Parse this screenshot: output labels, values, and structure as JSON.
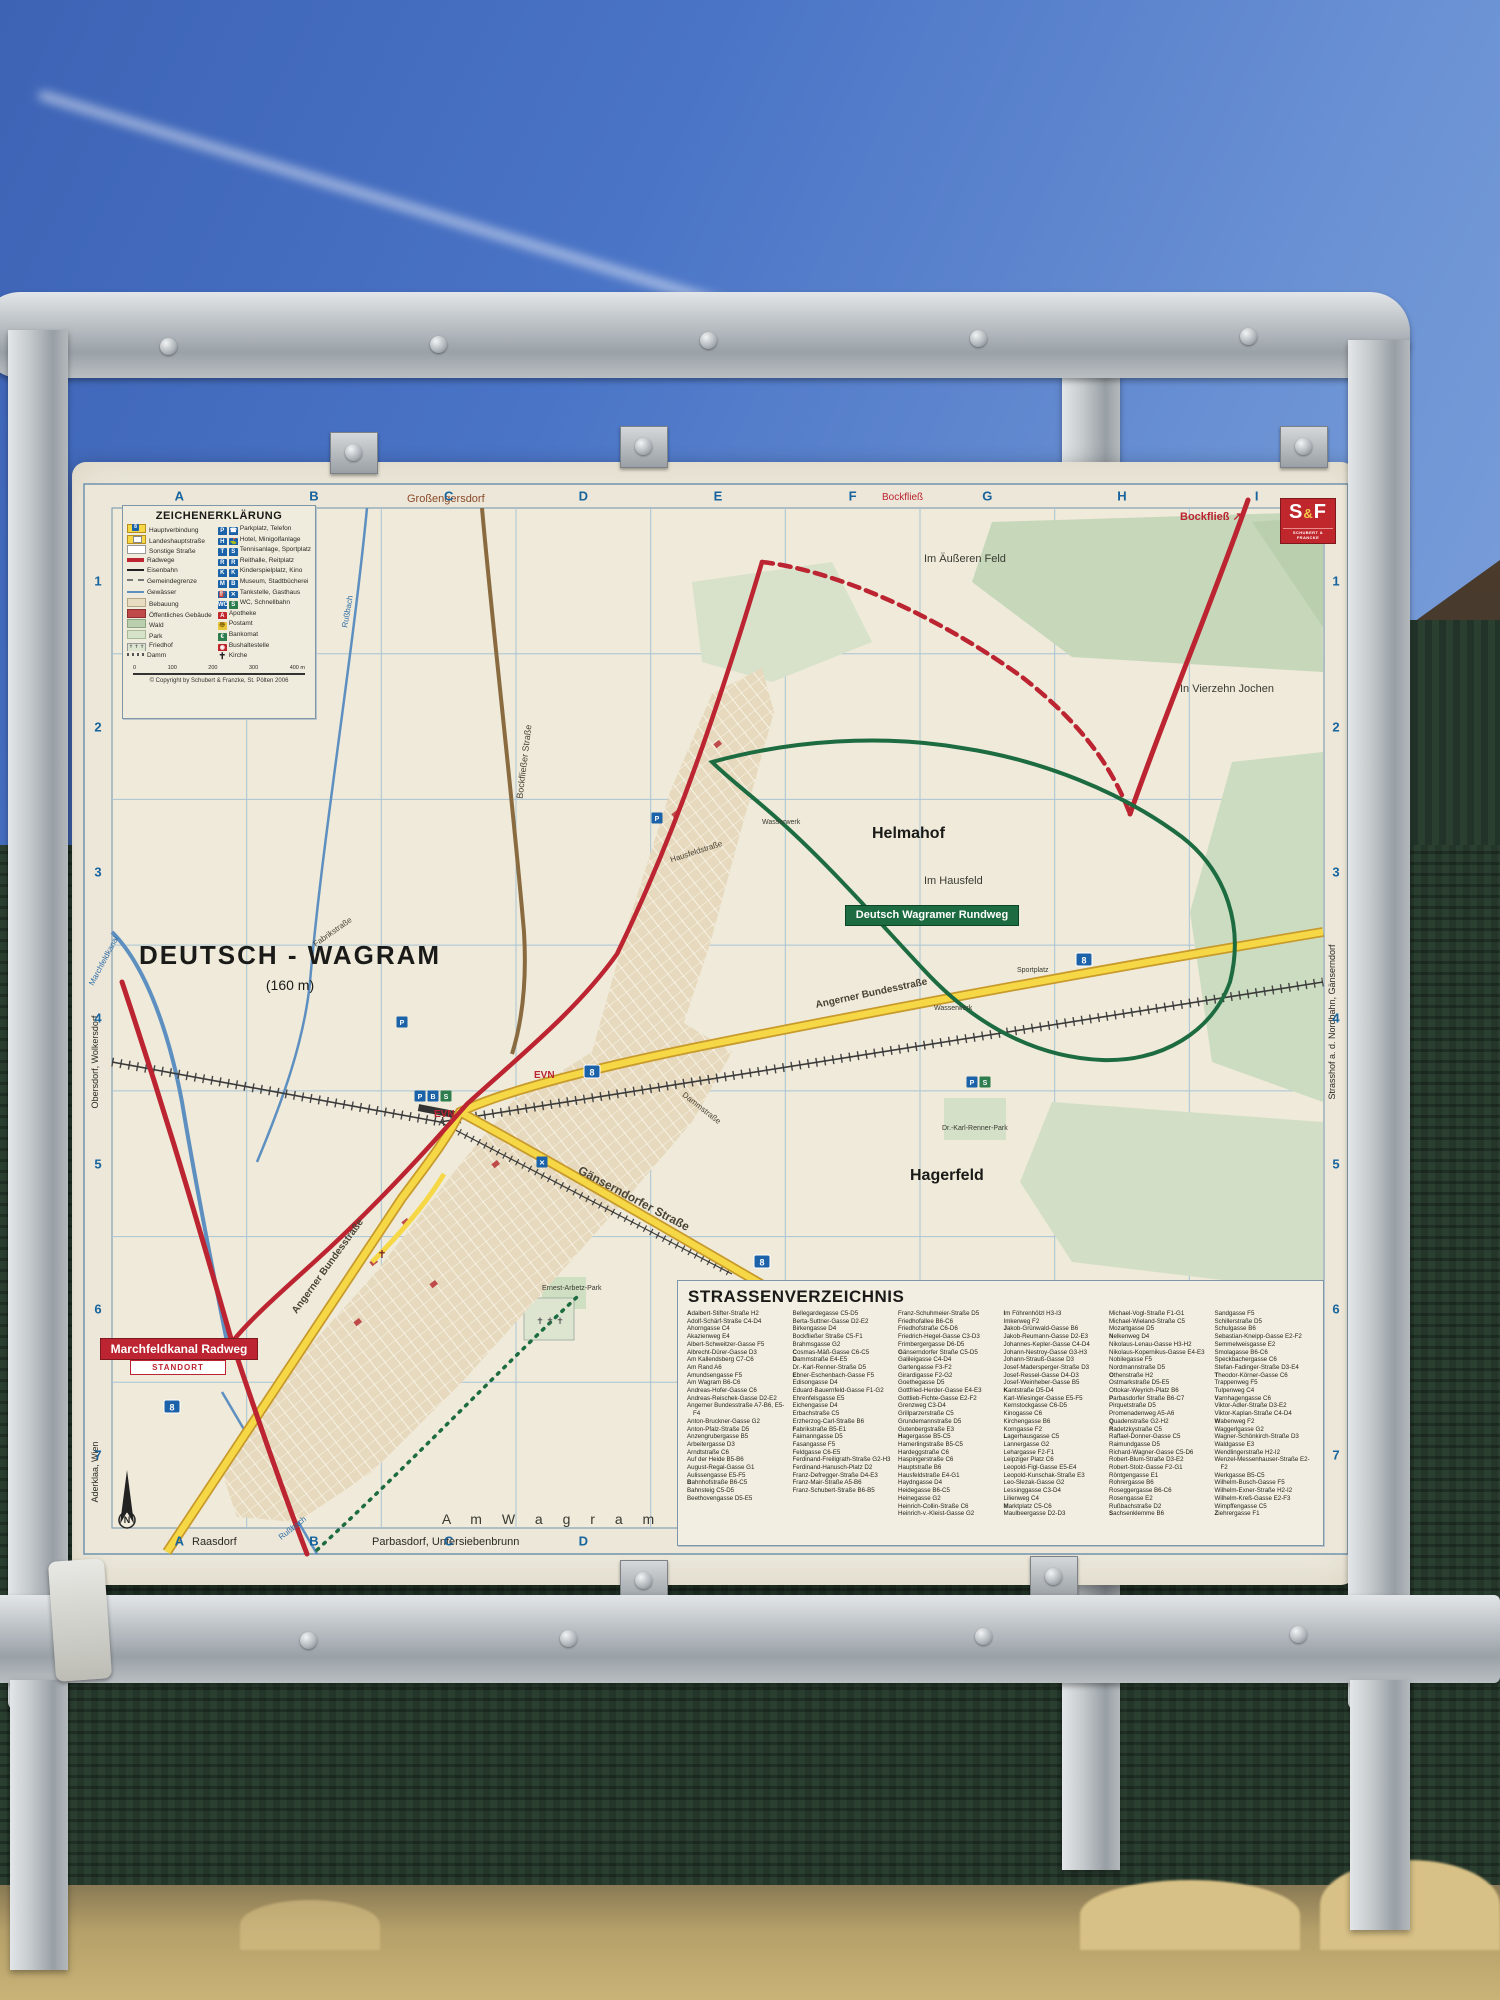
{
  "sign": {
    "title_label": "DEUTSCH - WAGRAM",
    "elevation": "(160 m)",
    "grid": {
      "cols": [
        "A",
        "B",
        "C",
        "D",
        "E",
        "F",
        "G",
        "H",
        "I"
      ],
      "rows": [
        "1",
        "2",
        "3",
        "4",
        "5",
        "6",
        "7"
      ]
    },
    "publisher": {
      "logo_s": "S",
      "logo_amp": "&",
      "logo_f": "F",
      "sub": "SCHUBERT & FRANCKE"
    },
    "legend": {
      "title": "ZEICHENERKLÄRUNG",
      "left": [
        {
          "sym": "main",
          "label": "Hauptverbindung"
        },
        {
          "sym": "lh",
          "label": "Landeshauptstraße"
        },
        {
          "sym": "other",
          "label": "Sonstige Straße"
        },
        {
          "sym": "rad",
          "label": "Radwege"
        },
        {
          "sym": "rail",
          "label": "Eisenbahn"
        },
        {
          "sym": "gem",
          "label": "Gemeindegrenze"
        },
        {
          "sym": "wat",
          "label": "Gewässer"
        },
        {
          "sym": "beb",
          "label": "Bebauung"
        },
        {
          "sym": "pub",
          "label": "Öffentliches Gebäude"
        },
        {
          "sym": "wald",
          "label": "Wald"
        },
        {
          "sym": "park",
          "label": "Park"
        },
        {
          "sym": "fried",
          "label": "Friedhof"
        },
        {
          "sym": "damm",
          "label": "Damm"
        }
      ],
      "right": [
        {
          "icons": [
            {
              "g": "P",
              "c": "blue"
            },
            {
              "g": "☎",
              "c": "blue"
            }
          ],
          "label": "Parkplatz, Telefon"
        },
        {
          "icons": [
            {
              "g": "H",
              "c": "blue"
            },
            {
              "g": "⛳",
              "c": "blue"
            }
          ],
          "label": "Hotel, Minigolfanlage"
        },
        {
          "icons": [
            {
              "g": "T",
              "c": "blue"
            },
            {
              "g": "S",
              "c": "blue"
            }
          ],
          "label": "Tennisanlage, Sportplatz"
        },
        {
          "icons": [
            {
              "g": "R",
              "c": "blue"
            },
            {
              "g": "R",
              "c": "blue"
            }
          ],
          "label": "Reithalle, Reitplatz"
        },
        {
          "icons": [
            {
              "g": "K",
              "c": "blue"
            },
            {
              "g": "K",
              "c": "blue"
            }
          ],
          "label": "Kinderspielplatz, Kino"
        },
        {
          "icons": [
            {
              "g": "M",
              "c": "blue"
            },
            {
              "g": "B",
              "c": "blue"
            }
          ],
          "label": "Museum, Stadtbücherei"
        },
        {
          "icons": [
            {
              "g": "⛽",
              "c": "blue"
            },
            {
              "g": "✕",
              "c": "blue"
            }
          ],
          "label": "Tankstelle, Gasthaus"
        },
        {
          "icons": [
            {
              "g": "WC",
              "c": "blue"
            },
            {
              "g": "S",
              "c": "grn"
            }
          ],
          "label": "WC, Schnellbahn"
        },
        {
          "icons": [
            {
              "g": "A",
              "c": "red"
            }
          ],
          "label": "Apotheke"
        },
        {
          "icons": [
            {
              "g": "〠",
              "c": "yel"
            }
          ],
          "label": "Postamt"
        },
        {
          "icons": [
            {
              "g": "€",
              "c": "grn"
            }
          ],
          "label": "Bankomat"
        },
        {
          "icons": [
            {
              "g": "◉",
              "c": "red"
            }
          ],
          "label": "Bushaltestelle"
        },
        {
          "icons": [
            {
              "g": "✝",
              "c": "plain"
            }
          ],
          "label": "Kirche"
        }
      ],
      "scale_ticks": [
        "0",
        "100",
        "200",
        "300",
        "400 m"
      ],
      "copyright": "© Copyright by Schubert & Franzke, St. Pölten 2006"
    },
    "badges": {
      "rundweg": "Deutsch Wagramer Rundweg",
      "radweg": "Marchfeldkanal Radweg",
      "standort": "STANDORT"
    },
    "map_labels": [
      {
        "n": "town-title",
        "t": "DEUTSCH - WAGRAM",
        "x": 218,
        "y": 502,
        "s": 26,
        "w": "bold",
        "ls": 2,
        "a": "middle",
        "c": "#1a1a18"
      },
      {
        "n": "town-elevation",
        "t": "(160 m)",
        "x": 218,
        "y": 528,
        "s": 14,
        "a": "middle",
        "c": "#1a1a18"
      },
      {
        "n": "district-helmahof",
        "t": "Helmahof",
        "x": 800,
        "y": 376,
        "s": 16,
        "w": "bold",
        "c": "#1a1a18"
      },
      {
        "n": "district-hagerfeld",
        "t": "Hagerfeld",
        "x": 838,
        "y": 718,
        "s": 16,
        "w": "bold",
        "c": "#1a1a18"
      },
      {
        "n": "area-im-hausfeld",
        "t": "Im Hausfeld",
        "x": 852,
        "y": 422,
        "s": 11,
        "c": "#3a3a32"
      },
      {
        "n": "area-im-aeusseren-feld",
        "t": "Im Äußeren Feld",
        "x": 852,
        "y": 100,
        "s": 11,
        "c": "#3a3a32"
      },
      {
        "n": "area-in-vierzehn-jochen",
        "t": "In Vierzehn Jochen",
        "x": 1108,
        "y": 230,
        "s": 11,
        "c": "#3a3a32"
      },
      {
        "n": "area-am-seelies",
        "t": "Am Seelies",
        "x": 1130,
        "y": 832,
        "s": 11,
        "c": "#3a3a32"
      },
      {
        "n": "area-am-wagram",
        "t": "A m   W a g r a m",
        "x": 480,
        "y": 1062,
        "s": 14,
        "ls": 8,
        "a": "middle",
        "c": "#3a3a32"
      },
      {
        "n": "dest-grossengersdorf",
        "t": "Großengersdorf",
        "x": 335,
        "y": 40,
        "s": 11,
        "c": "#8a4a2a"
      },
      {
        "n": "dest-bockfliess-f",
        "t": "Bockfließ",
        "x": 810,
        "y": 38,
        "s": 10,
        "c": "#bb2430"
      },
      {
        "n": "dest-bockfliess-ne",
        "t": "Bockfließ ↗",
        "x": 1108,
        "y": 58,
        "s": 11,
        "w": "bold",
        "c": "#bb2430"
      },
      {
        "n": "dest-raasdorf",
        "t": "Raasdorf",
        "x": 120,
        "y": 1083,
        "s": 11,
        "c": "#2a2a25"
      },
      {
        "n": "dest-parbasdorf",
        "t": "Parbasdorf, Untersiebenbrunn",
        "x": 300,
        "y": 1083,
        "s": 11,
        "c": "#2a2a25"
      },
      {
        "n": "margin-aderklaa",
        "t": "Aderklaa, Wien",
        "x": 26,
        "y": 1010,
        "s": 9,
        "r": -90,
        "a": "middle",
        "c": "#2a2a25"
      },
      {
        "n": "margin-obersdorf",
        "t": "Obersdorf, Wolkersdorf",
        "x": 26,
        "y": 600,
        "s": 9,
        "r": -90,
        "a": "middle",
        "c": "#2a2a25"
      },
      {
        "n": "margin-strasshof",
        "t": "Strasshof a. d. Nordbahn, Gänserndorf",
        "x": 1263,
        "y": 560,
        "s": 9,
        "r": -90,
        "a": "middle",
        "c": "#2a2a25"
      },
      {
        "n": "street-angerner-sw",
        "t": "Angerner Bundesstraße",
        "x": 258,
        "y": 806,
        "s": 10,
        "w": "bold",
        "r": -54,
        "a": "middle",
        "c": "#4a4436"
      },
      {
        "n": "street-angerner-e",
        "t": "Angerner Bundesstraße",
        "x": 800,
        "y": 534,
        "s": 10,
        "w": "bold",
        "r": -12,
        "a": "middle",
        "c": "#4a4436"
      },
      {
        "n": "street-gaenserndorfer",
        "t": "Gänserndorfer Straße",
        "x": 560,
        "y": 740,
        "s": 12,
        "w": "bold",
        "r": 28,
        "a": "middle",
        "c": "#4a4436"
      },
      {
        "n": "street-bockfliesser",
        "t": "Bockfließer Straße",
        "x": 455,
        "y": 300,
        "s": 9,
        "r": -83,
        "a": "middle",
        "c": "#4a4436"
      },
      {
        "n": "street-hausfeldstrasse",
        "t": "Hausfeldstraße",
        "x": 625,
        "y": 392,
        "s": 8,
        "r": -18,
        "a": "middle",
        "c": "#4a4436"
      },
      {
        "n": "street-dammstrasse",
        "t": "Dammstraße",
        "x": 628,
        "y": 648,
        "s": 8,
        "r": 38,
        "a": "middle",
        "c": "#4a4436"
      },
      {
        "n": "street-fabrikstrasse",
        "t": "Fabrikstraße",
        "x": 262,
        "y": 472,
        "s": 8,
        "r": -35,
        "a": "middle",
        "c": "#4a4436"
      },
      {
        "n": "water-russbach-n",
        "t": "Rußbach",
        "x": 278,
        "y": 150,
        "s": 8,
        "r": -80,
        "a": "middle",
        "c": "#2f6da8"
      },
      {
        "n": "water-russbach-s",
        "t": "Rußbach",
        "x": 222,
        "y": 1068,
        "s": 8,
        "r": -38,
        "a": "middle",
        "c": "#2f6da8"
      },
      {
        "n": "water-marchfeldkanal",
        "t": "Marchfeldkanal",
        "x": 34,
        "y": 500,
        "s": 8,
        "r": -62,
        "a": "middle",
        "c": "#2f6da8"
      },
      {
        "n": "poi-evn-1",
        "t": "EVN",
        "x": 462,
        "y": 616,
        "s": 10,
        "w": "bold",
        "c": "#bb2430"
      },
      {
        "n": "poi-evn-2",
        "t": "EVN",
        "x": 362,
        "y": 655,
        "s": 10,
        "w": "bold",
        "c": "#bb2430"
      },
      {
        "n": "poi-wasserwerk-1",
        "t": "Wasserwerk",
        "x": 690,
        "y": 362,
        "s": 7,
        "c": "#3a3a32"
      },
      {
        "n": "poi-wasserwerk-2",
        "t": "Wasserwerk",
        "x": 862,
        "y": 548,
        "s": 7,
        "c": "#3a3a32"
      },
      {
        "n": "poi-sportplatz",
        "t": "Sportplatz",
        "x": 945,
        "y": 510,
        "s": 7,
        "c": "#3a3a32"
      },
      {
        "n": "poi-ernest-arbetz-park",
        "t": "Ernest-Arbetz-Park",
        "x": 470,
        "y": 828,
        "s": 7,
        "c": "#3a3a32"
      },
      {
        "n": "poi-karl-renner-park",
        "t": "Dr.-Karl-Renner-Park",
        "x": 870,
        "y": 668,
        "s": 7,
        "c": "#3a3a32"
      },
      {
        "n": "poi-friedhof-crosses",
        "t": "✝ ✝ ✝",
        "x": 478,
        "y": 862,
        "s": 9,
        "a": "middle",
        "c": "#555"
      },
      {
        "n": "poi-kirche-cross",
        "t": "✝",
        "x": 310,
        "y": 796,
        "s": 11,
        "a": "middle",
        "c": "#7a1f1f"
      }
    ],
    "shields": [
      {
        "t": "8",
        "x": 100,
        "y": 945
      },
      {
        "t": "8",
        "x": 520,
        "y": 610
      },
      {
        "t": "8",
        "x": 1012,
        "y": 498
      },
      {
        "t": "8",
        "x": 690,
        "y": 800
      }
    ],
    "poi_icons": [
      {
        "g": "P",
        "x": 348,
        "y": 634,
        "c": "#1b62a8"
      },
      {
        "g": "B",
        "x": 361,
        "y": 634,
        "c": "#1b62a8"
      },
      {
        "g": "S",
        "x": 374,
        "y": 634,
        "c": "#2e7d4f"
      },
      {
        "g": "P",
        "x": 585,
        "y": 356,
        "c": "#1b62a8"
      },
      {
        "g": "P",
        "x": 900,
        "y": 620,
        "c": "#1b62a8"
      },
      {
        "g": "S",
        "x": 913,
        "y": 620,
        "c": "#2e7d4f"
      },
      {
        "g": "✕",
        "x": 470,
        "y": 700,
        "c": "#1b62a8"
      },
      {
        "g": "P",
        "x": 330,
        "y": 560,
        "c": "#1b62a8"
      }
    ],
    "index": {
      "title": "STRASSENVERZEICHNIS",
      "columns": [
        [
          "Adalbert-Stifter-Straße H2",
          "Adolf-Schärf-Straße C4-D4",
          "Ahorngasse C4",
          "Akazienweg E4",
          "Albert-Schweitzer-Gasse F5",
          "Albrecht-Dürer-Gasse D3",
          "Am Kallendsberg C7-C6",
          "Am Rand A6",
          "Amundsengasse F5",
          "Am Wagram B6-C6",
          "Andreas-Hofer-Gasse C6",
          "Andreas-Reischek-Gasse D2-E2",
          "Angerner Bundesstraße A7-B6, E5-F4",
          "Anton-Bruckner-Gasse G2",
          "Anton-Pfalz-Straße D5",
          "Anzengrubergasse B5",
          "Arbeitergasse D3",
          "Arndtstraße C6",
          "Auf der Heide B5-B6",
          "August-Regal-Gasse G1",
          "Aulissengasse E5-F5",
          "Bahnhofstraße B6-C5",
          "Bahnsteig C5-D5",
          "Beethovengasse D5-E5"
        ],
        [
          "Bellegardegasse C5-D5",
          "Berta-Suttner-Gasse D2-E2",
          "Birkengasse D4",
          "Bockfließer Straße C5-F1",
          "Brahmsgasse G2",
          "Cosmas-Mäß-Gasse C6-C5",
          "Dammstraße E4-E5",
          "Dr.-Karl-Renner-Straße D5",
          "Ebner-Eschenbach-Gasse F5",
          "Edisongasse D4",
          "Eduard-Bauernfeld-Gasse F1-G2",
          "Ehrenfelsgasse E5",
          "Eichengasse D4",
          "Erbachstraße C5",
          "Erzherzog-Carl-Straße B6",
          "Fabrikstraße B5-E1",
          "Faimanngasse D5",
          "Fasangasse F5",
          "Feldgasse C6-E5",
          "Ferdinand-Freiligrath-Straße G2-H3",
          "Ferdinand-Hanusch-Platz D2",
          "Franz-Defregger-Straße D4-E3",
          "Franz-Mair-Straße A5-B6",
          "Franz-Schubert-Straße B6-B5"
        ],
        [
          "Franz-Schuhmeier-Straße D5",
          "Friedhofallee B6-C6",
          "Friedhofstraße C6-D6",
          "Friedrich-Hegel-Gasse C3-D3",
          "Frimbergergasse D6-D5",
          "Gänserndorfer Straße C5-D5",
          "Galileigasse C4-D4",
          "Gartengasse F3-F2",
          "Girardigasse F2-G2",
          "Goethegasse D5",
          "Gottfried-Herder-Gasse E4-E3",
          "Gottlieb-Fichte-Gasse E2-F2",
          "Grenzweg C3-D4",
          "Grillparzerstraße C5",
          "Grundemannstraße D5",
          "Gutenbergstraße E3",
          "Hagergasse B5-C5",
          "Hamerlingstraße B5-C5",
          "Hardeggstraße C6",
          "Haspingerstraße C6",
          "Hauptstraße B6",
          "Hausfeldstraße E4-G1",
          "Haydngasse D4",
          "Heidegasse B6-C5",
          "Heinegasse G2",
          "Heinrich-Collin-Straße C6",
          "Heinrich-v.-Kleist-Gasse G2"
        ],
        [
          "Im Föhrenhölzl H3-I3",
          "Imkerweg F2",
          "Jakob-Grünwald-Gasse B6",
          "Jakob-Reumann-Gasse D2-E3",
          "Johannes-Kepler-Gasse C4-D4",
          "Johann-Nestroy-Gasse G3-H3",
          "Johann-Strauß-Gasse D3",
          "Josef-Madersperger-Straße D3",
          "Josef-Ressel-Gasse D4-D3",
          "Josef-Weinheber-Gasse B5",
          "Kantstraße D5-D4",
          "Karl-Wiesinger-Gasse E5-F5",
          "Kernstockgasse C6-D5",
          "Kinogasse C6",
          "Kirchengasse B6",
          "Korngasse F2",
          "Lagerhausgasse C5",
          "Lannergasse G2",
          "Lehargasse F2-F1",
          "Leipziger Platz C6",
          "Leopold-Figl-Gasse E5-E4",
          "Leopold-Kunschak-Straße E3",
          "Leo-Slezak-Gasse G2",
          "Lessinggasse C3-D4",
          "Lilienweg C4",
          "Marktplatz C5-C6",
          "Maulbeergasse D2-D3"
        ],
        [
          "Michael-Vogl-Straße F1-G1",
          "Michael-Wieland-Straße C5",
          "Mozartgasse D5",
          "Nelkenweg D4",
          "Nikolaus-Lenau-Gasse H3-H2",
          "Nikolaus-Kopernikus-Gasse E4-E3",
          "Nobilegasse F5",
          "Nordmannstraße D5",
          "Othenstraße H2",
          "Ostmarkstraße D5-E5",
          "Ottokar-Weyrich-Platz B6",
          "Parbasdorfer Straße B6-C7",
          "Pirquetstraße D5",
          "Promenadenweg A5-A6",
          "Quadenstraße G2-H2",
          "Radetzkystraße C5",
          "Raffael-Donner-Gasse C5",
          "Raimundgasse D5",
          "Richard-Wagner-Gasse C5-D6",
          "Robert-Blum-Straße D3-E2",
          "Robert-Stolz-Gasse F2-G1",
          "Röntgengasse E1",
          "Rohrergasse B6",
          "Roseggergasse B6-C6",
          "Rosengasse E2",
          "Rußbachstraße D2",
          "Sachsenklemme B6"
        ],
        [
          "Sandgasse F5",
          "Schillerstraße D5",
          "Schulgasse B6",
          "Sebastian-Kneipp-Gasse E2-F2",
          "Semmelweisgasse E2",
          "Smolagasse B6-C6",
          "Speckbachergasse C6",
          "Stefan-Fadinger-Straße D3-E4",
          "Theodor-Körner-Gasse C6",
          "Trappenweg F5",
          "Tulpenweg C4",
          "Varnhagengasse C6",
          "Viktor-Adler-Straße D3-E2",
          "Viktor-Kaplan-Straße C4-D4",
          "Wabenweg F2",
          "Waggerlgasse G2",
          "Wagner-Schönkirch-Straße D3",
          "Waldgasse E3",
          "Wendlingerstraße H2-I2",
          "Wenzel-Messenhauser-Straße E2-F2",
          "Werkgasse B5-C5",
          "Wilhelm-Busch-Gasse F5",
          "Wilhelm-Exner-Straße H2-I2",
          "Wilhelm-Kreß-Gasse E2-F3",
          "Wimpffengasse C5",
          "Ziehrergasse F1"
        ]
      ]
    }
  }
}
